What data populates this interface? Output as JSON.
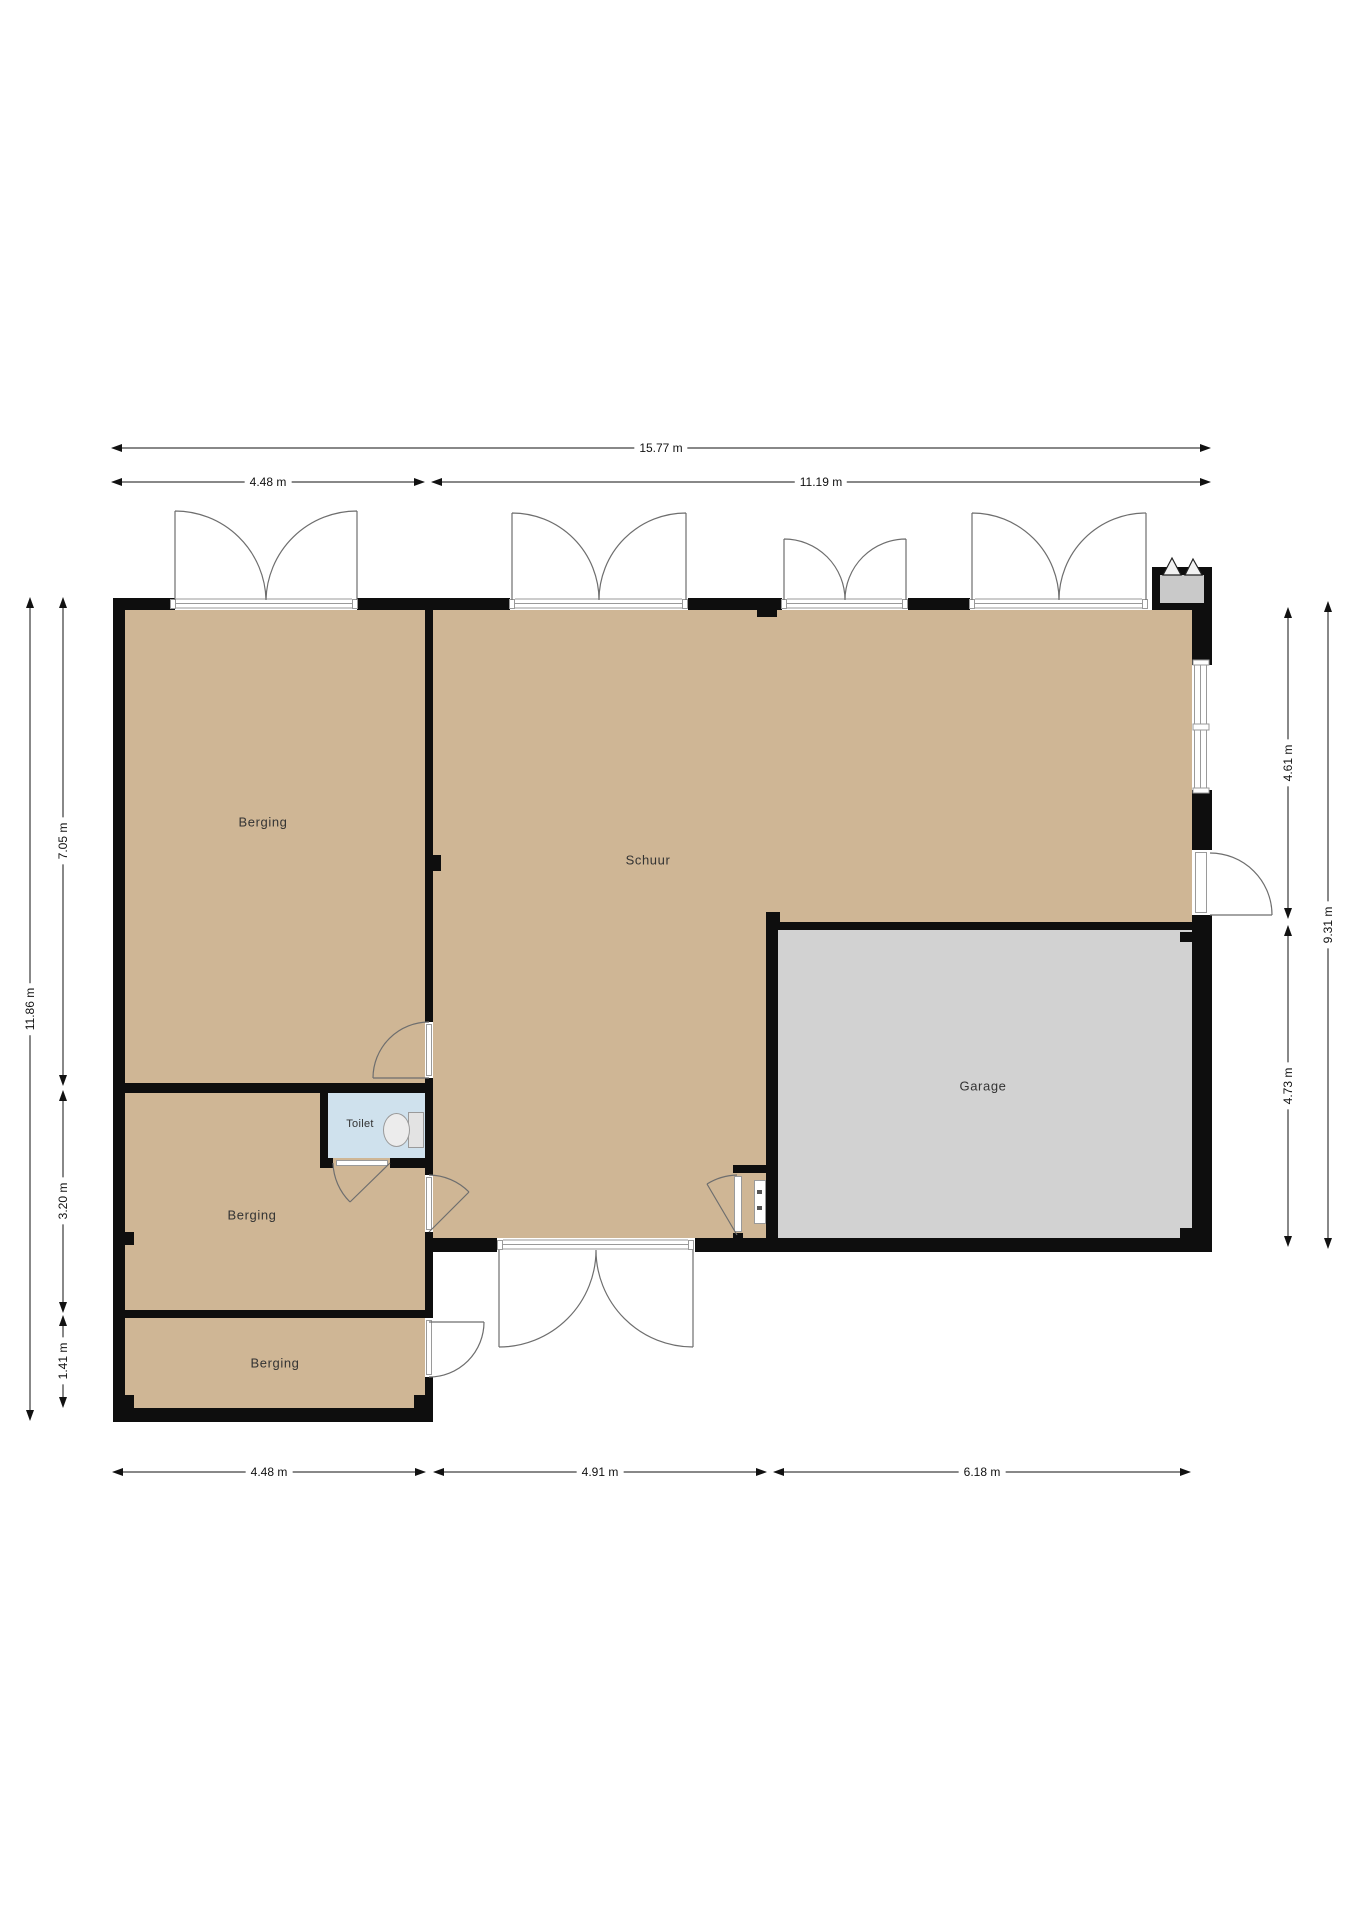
{
  "rooms": {
    "berging_top": {
      "label": "Berging"
    },
    "schuur": {
      "label": "Schuur"
    },
    "garage": {
      "label": "Garage"
    },
    "toilet": {
      "label": "Toilet"
    },
    "berging_mid": {
      "label": "Berging"
    },
    "berging_bottom": {
      "label": "Berging"
    }
  },
  "dimensions": {
    "top_total": "15.77 m",
    "top_left": "4.48 m",
    "top_right": "11.19 m",
    "bottom_left": "4.48 m",
    "bottom_mid": "4.91 m",
    "bottom_right": "6.18 m",
    "left_total": "11.86 m",
    "left_top": "7.05 m",
    "left_mid": "3.20 m",
    "left_bottom": "1.41 m",
    "right_total": "9.31 m",
    "right_top": "4.61 m",
    "right_bottom": "4.73 m"
  },
  "colors": {
    "floor_beige": "#cfb695",
    "garage_gray": "#d2d2d2",
    "toilet_blue": "#cfe1ed",
    "wall_black": "#0e0e0e",
    "door_line_gray": "#6e6e6e"
  }
}
